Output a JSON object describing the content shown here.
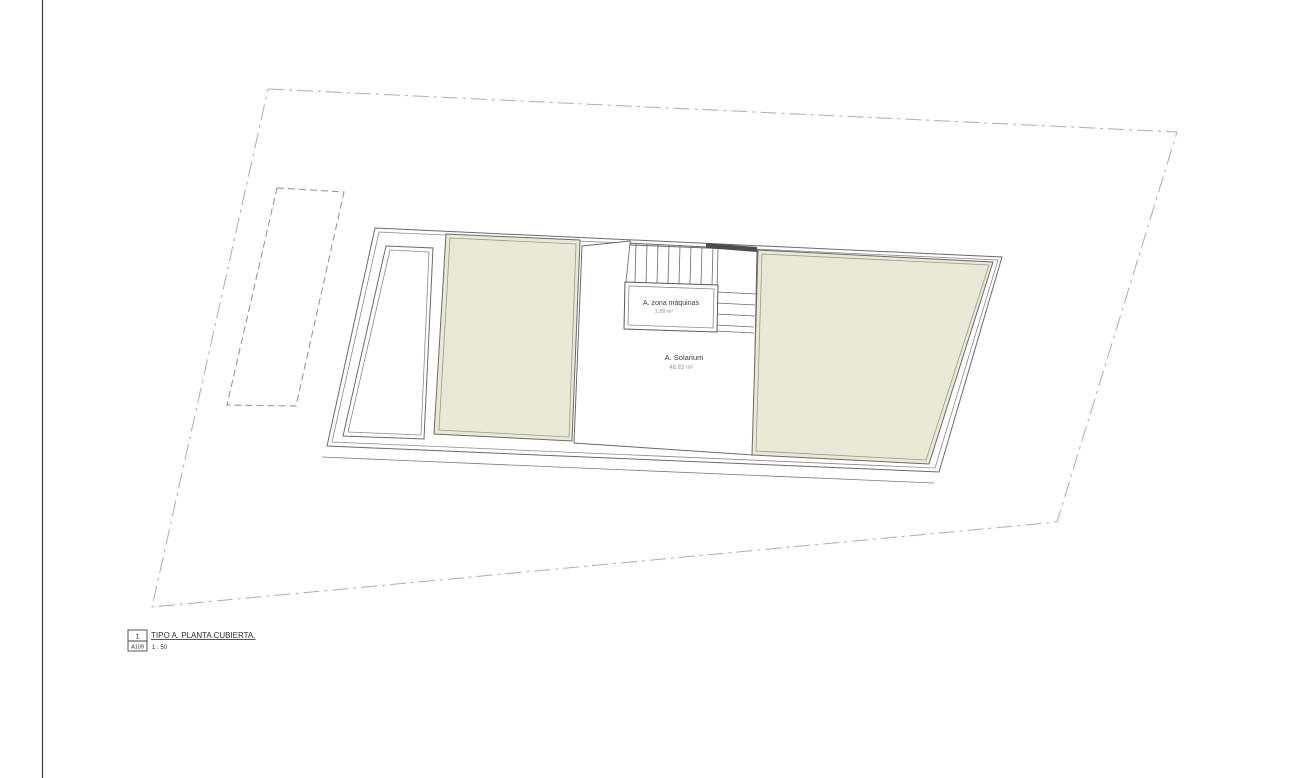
{
  "plan": {
    "rooms": [
      {
        "name": "A. zona máquinas",
        "area": "1.88 m²"
      },
      {
        "name": "A. Solarium",
        "area": "48.83 m²"
      }
    ],
    "title_block": {
      "detail_number": "1",
      "sheet_number": "A109",
      "title": "TIPO A. PLANTA CUBIERTA.",
      "scale": "1 : 50"
    },
    "colors": {
      "green_roof_fill": "#e9e9d8",
      "boundary_line": "#c4a4a4",
      "parking_dash_line": "#8f8f8f",
      "building_line": "#6a6a6a",
      "building_line_light": "#9a9a8a",
      "dark_wall": "#4c4c4c"
    }
  }
}
